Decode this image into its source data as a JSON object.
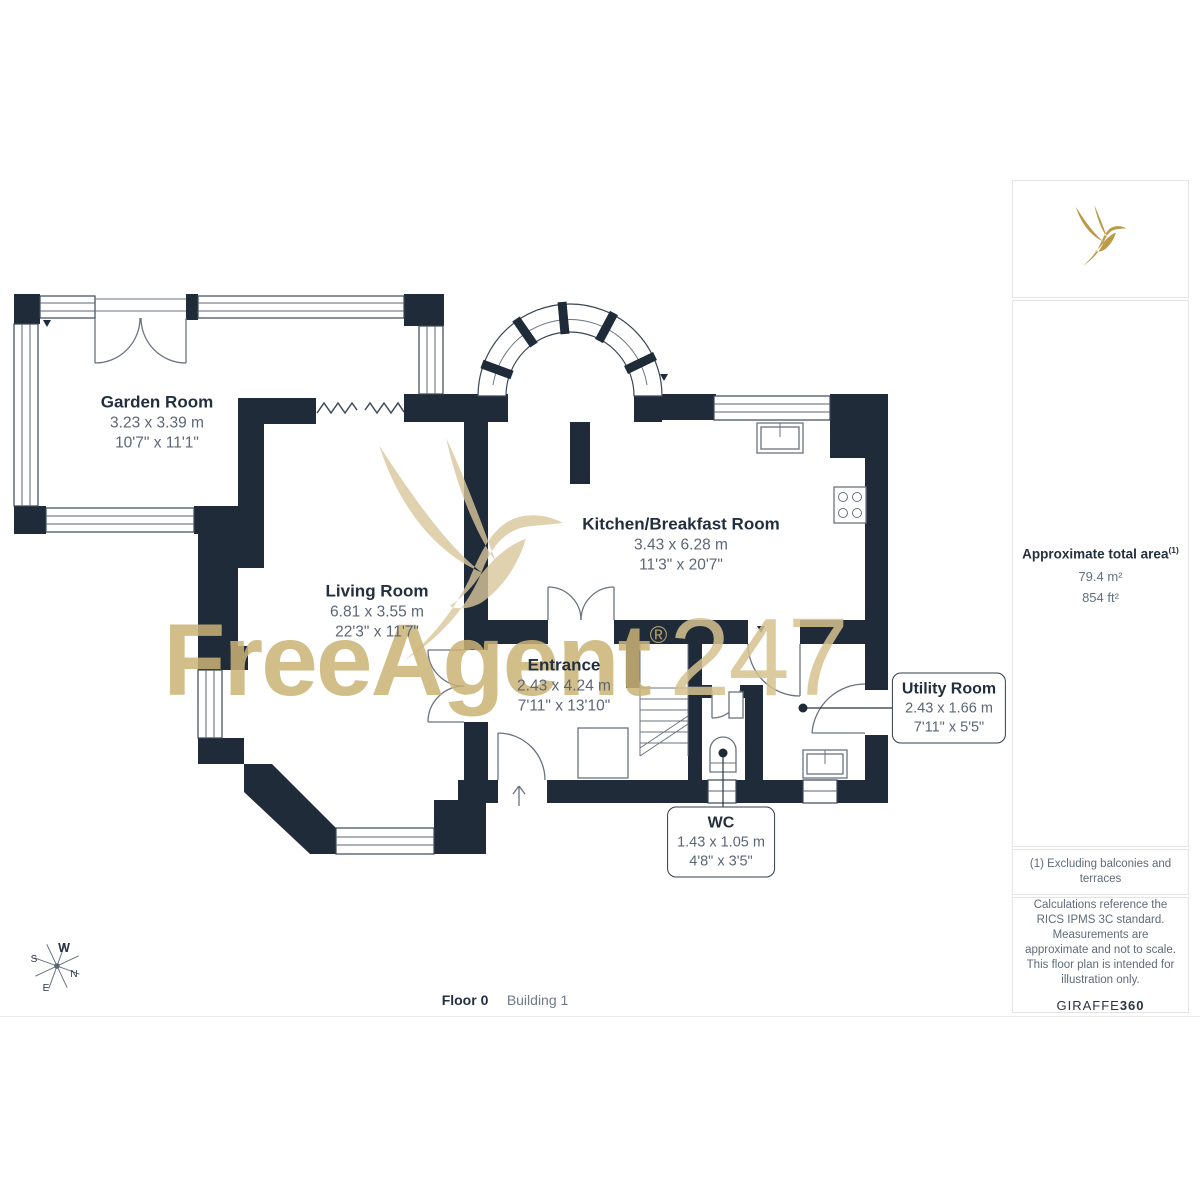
{
  "watermark": {
    "brand": "FreeAgent",
    "reg": "®",
    "suffix": "247"
  },
  "rooms": [
    {
      "name": "Garden Room",
      "metric": "3.23 x 3.39 m",
      "imperial": "10'7\" x 11'1\""
    },
    {
      "name": "Living Room",
      "metric": "6.81 x 3.55 m",
      "imperial": "22'3\" x 11'7\""
    },
    {
      "name": "Kitchen/Breakfast Room",
      "metric": "3.43 x 6.28 m",
      "imperial": "11'3\" x 20'7\""
    },
    {
      "name": "Entrance",
      "metric": "2.43 x 4.24 m",
      "imperial": "7'11\" x 13'10\""
    },
    {
      "name": "WC",
      "metric": "1.43 x 1.05 m",
      "imperial": "4'8\" x 3'5\""
    },
    {
      "name": "Utility Room",
      "metric": "2.43 x 1.66 m",
      "imperial": "7'11\" x 5'5\""
    }
  ],
  "compass": {
    "n": "N",
    "s": "S",
    "e": "E",
    "w": "W"
  },
  "footer": {
    "floor": "Floor 0",
    "building": "Building 1"
  },
  "sidebar": {
    "area_title": "Approximate total area",
    "area_sup": "(1)",
    "area_m2": "79.4 m²",
    "area_ft2": "854 ft²",
    "footnote": "(1) Excluding balconies and terraces",
    "disclaimer": "Calculations reference the RICS IPMS 3C standard. Measurements are approximate and not to scale. This floor plan is intended for illustration only.",
    "brand": "GIRAFFE",
    "brand_bold": "360"
  },
  "colors": {
    "wall": "#202b3a",
    "gold": "#bd9a47",
    "watermark_gold": "#cbb375"
  }
}
